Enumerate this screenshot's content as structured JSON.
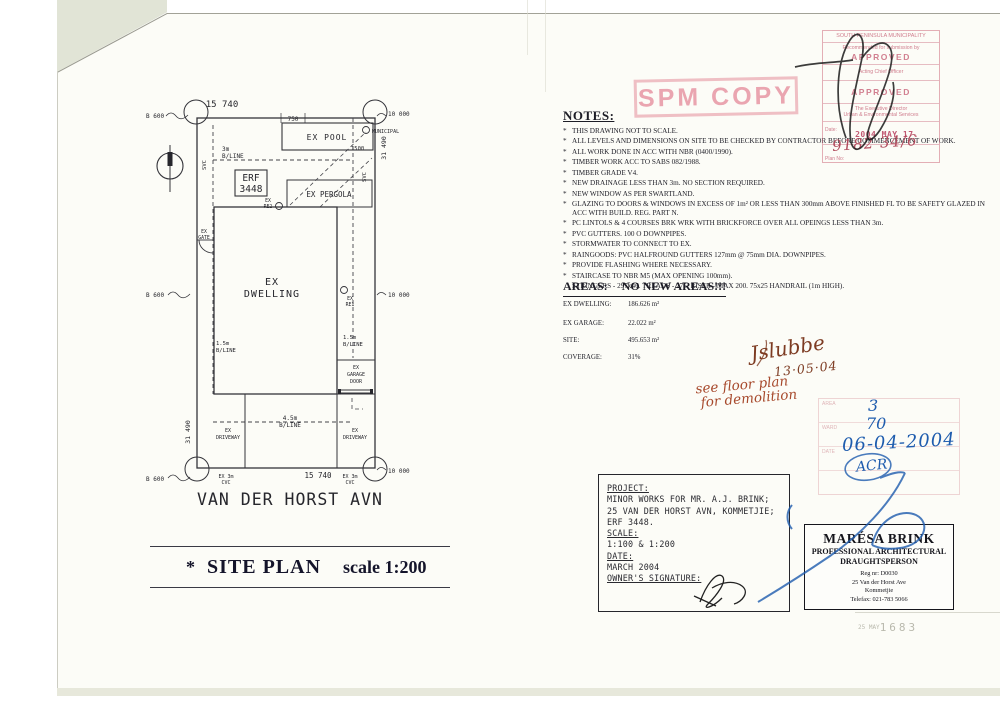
{
  "colors": {
    "stamp_pink": "#d4848f",
    "pen_blue": "#1e5cae",
    "pen_black": "#1c1c1c",
    "ink_brown": "#7d3b22",
    "ink_red": "#a7492c",
    "paper": "#fcfcf7"
  },
  "site_plan": {
    "street": "VAN DER HORST AVN",
    "title_star": "*",
    "title": "SITE PLAN",
    "title_scale": "scale 1:200",
    "labels": {
      "dim_15740": "15 740",
      "dim_750": "750",
      "dim_1500": "1500",
      "dim_31490": "31 490",
      "b600": "B 600",
      "d10000": "10 000",
      "municipal": "MUNICIPAL",
      "svc": "SVC",
      "bline_3m": "3m",
      "bline_15": "1.5m",
      "bline_45": "4.5m",
      "bline": "B/LINE",
      "erf": "ERF",
      "erf_no": "3448",
      "ex": "EX",
      "pool": "EX POOL",
      "pergola": "EX PERGOLA",
      "re1": "RE1",
      "re2": "RE2",
      "gate": "GATE",
      "dwelling": "DWELLING",
      "garage": "GARAGE",
      "door": "DOOR",
      "driveway": "DRIVEWAY",
      "cvc_top": "EX 3m",
      "cvc": "CVC"
    }
  },
  "notes": {
    "heading": "NOTES:",
    "bullet": "*",
    "items": [
      "THIS DRAWING NOT TO SCALE.",
      "ALL LEVELS AND DIMENSIONS ON SITE TO BE CHECKED BY CONTRACTOR BEFORE COMMENCEMENT OF WORK.",
      "ALL WORK DONE IN ACC WITH NBR (0400/1990).",
      "TIMBER WORK ACC TO SABS 082/1988.",
      "TIMBER GRADE V4.",
      "NEW DRAINAGE LESS THAN 3m.  NO SECTION REQUIRED.",
      "NEW WINDOW AS PER SWARTLAND.",
      "GLAZING TO DOORS & WINDOWS IN EXCESS OF 1m² OR LESS THAN 300mm ABOVE FINISHED FL TO BE SAFETY GLAZED IN ACC WITH BUILD. REG. PART N.",
      "PC LINTOLS & 4 COURSES BRK WRK WITH BRICKFORCE OVER ALL OPEINGS LESS THAN 3m.",
      "PVC GUTTERS.  100 O DOWNPIPES.",
      "STORMWATER TO CONNECT TO EX.",
      "RAINGOODS:  PVC HALFROUND GUTTERS 127mm @ 75mm DIA. DOWNPIPES.",
      "PROVIDE FLASHING WHERE NECESSARY.",
      "STAIRCASE TO NBR M5 (MAX OPENING 100mm)."
    ],
    "staircase_detail": "STRINGERS - 297x46.  TREADS - 275.  RISER - MAX 200.  75x25 HANDRAIL (1m HIGH)."
  },
  "areas": {
    "heading": "AREAS:",
    "headline": "NO NEW AREAS!!!",
    "rows": [
      {
        "label": "EX DWELLING:",
        "value": "186.626 m²"
      },
      {
        "label": "EX GARAGE:",
        "value": "22.022 m²"
      },
      {
        "label": "SITE:",
        "value": "495.653 m²"
      },
      {
        "label": "COVERAGE:",
        "value": "31%"
      }
    ]
  },
  "spm_stamp": {
    "text": "SPM COPY"
  },
  "municipal_stamp": {
    "line1": "SOUTH PENINSULA MUNICIPALITY",
    "line2": "Recommended for submission by",
    "approved1": "APPROVED",
    "line3": "Acting Chief Officer",
    "approved2": "APPROVED",
    "line4": "The Executive Director",
    "line5": "Urban & Environmental Services",
    "date_label": "Date:",
    "date_value": "2004 MAY 17.",
    "plan_no_label": "Plan No:",
    "plan_no_value": "9182 34/6"
  },
  "annotations": {
    "signature": "Jslubbe",
    "sig_date": "13·05·04",
    "red_note_1": "see floor plan",
    "red_note_2": "for demolition",
    "admin_area_label": "AREA",
    "admin_ward_label": "WARD",
    "admin_date_label": "DATE",
    "admin_area": "3",
    "admin_ward": "70",
    "admin_date": "06-04-2004",
    "admin_initials": "ACR"
  },
  "project_box": {
    "project_label": "PROJECT:",
    "line1": "MINOR WORKS FOR MR. A.J. BRINK;",
    "line2": "25 VAN DER HORST AVN, KOMMETJIE;",
    "line3": "ERF 3448.",
    "scale_label": "SCALE:",
    "scale_value": "1:100 & 1:200",
    "date_label": "DATE:",
    "date_value": "MARCH 2004",
    "owner_label": "OWNER'S SIGNATURE:"
  },
  "card": {
    "name": "MARÉSA BRINK",
    "role1": "PROFESSIONAL ARCHITECTURAL",
    "role2": "DRAUGHTSPERSON",
    "reg": "Reg nr: D0030",
    "addr1": "25 Van der Horst Ave",
    "addr2": "Kommetjie",
    "tel": "Telefax: 021-783 5066"
  },
  "doc_stamp": {
    "small": "25 MAY",
    "number": "1683"
  }
}
